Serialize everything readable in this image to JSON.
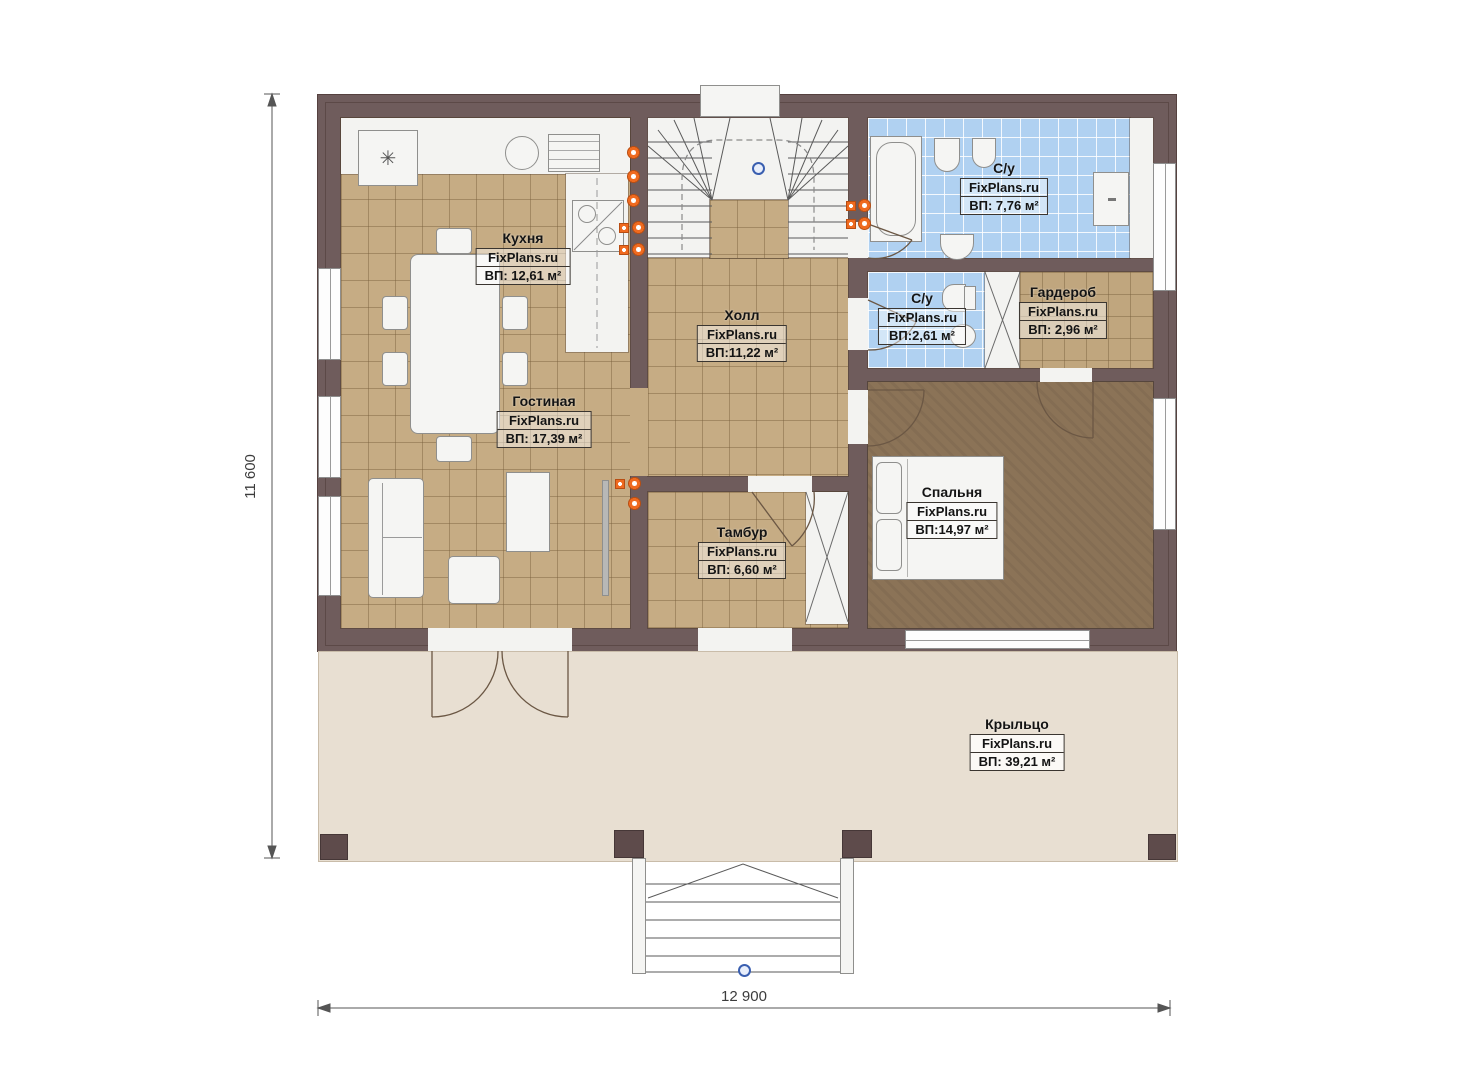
{
  "plan": {
    "brand_site": "FixPlans.ru",
    "rooms": [
      {
        "id": "kitchen",
        "name": "Кухня",
        "brand": "FixPlans.ru",
        "area": "ВП: 12,61 м²"
      },
      {
        "id": "hall",
        "name": "Холл",
        "brand": "FixPlans.ru",
        "area": "ВП:11,22 м²"
      },
      {
        "id": "bathroom",
        "name": "С/у",
        "brand": "FixPlans.ru",
        "area": "ВП: 7,76 м²"
      },
      {
        "id": "wc",
        "name": "С/у",
        "brand": "FixPlans.ru",
        "area": "ВП:2,61 м²"
      },
      {
        "id": "wardrobe",
        "name": "Гардероб",
        "brand": "FixPlans.ru",
        "area": "ВП: 2,96 м²"
      },
      {
        "id": "living",
        "name": "Гостиная",
        "brand": "FixPlans.ru",
        "area": "ВП: 17,39 м²"
      },
      {
        "id": "vestibule",
        "name": "Тамбур",
        "brand": "FixPlans.ru",
        "area": "ВП: 6,60 м²"
      },
      {
        "id": "bedroom",
        "name": "Спальня",
        "brand": "FixPlans.ru",
        "area": "ВП:14,97 м²"
      },
      {
        "id": "porch",
        "name": "Крыльцо",
        "brand": "FixPlans.ru",
        "area": "ВП: 39,21 м²"
      }
    ],
    "dimensions": {
      "height_label": "11 600",
      "width_label": "12 900"
    },
    "icons": {
      "fridge": "✳"
    },
    "colors": {
      "wall": "#6f5c5c",
      "tile_floor": "#c6ac84",
      "bath_floor": "#b0d1f1",
      "bedroom_floor": "#8b7357",
      "porch_floor": "#e8dfd2",
      "outlet_orange": "#ef6a1f",
      "marker_blue": "#3a5fb0"
    }
  }
}
